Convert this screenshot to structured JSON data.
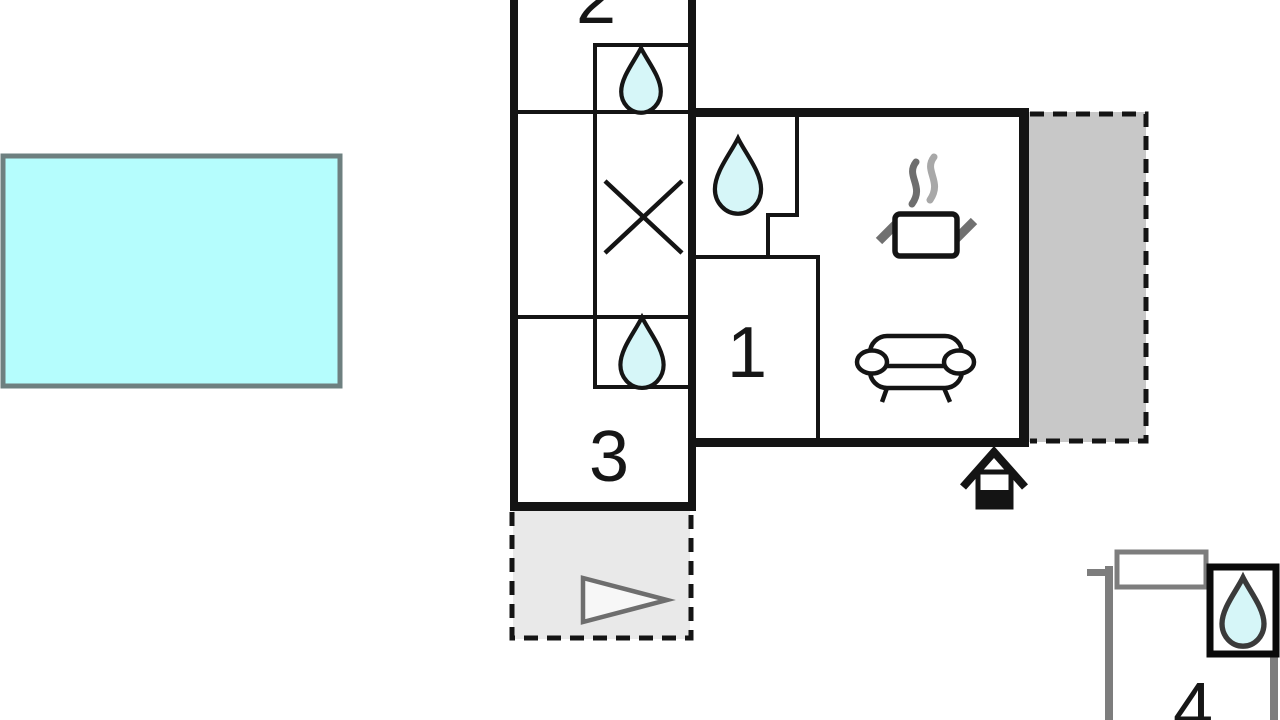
{
  "plan": {
    "type": "apartment-floor-plan",
    "rooms": {
      "room1": {
        "label": "1"
      },
      "room2": {
        "label": "2"
      },
      "room3": {
        "label": "3"
      },
      "room4": {
        "label": "4"
      }
    },
    "icons": [
      "water-drop-icon",
      "water-drop-icon",
      "water-drop-icon",
      "water-drop-icon",
      "x-cross-icon",
      "cooking-pot-steam-icon",
      "sofa-icon",
      "entrance-house-icon",
      "terrace-triangle-icon"
    ],
    "areas": [
      "pool",
      "terrace-right",
      "terrace-front",
      "room-4-annex"
    ]
  },
  "colors": {
    "pool_fill": "#b5fdfd",
    "pool_border": "#6e8080",
    "drop_fill": "#d6f6f8",
    "drop_outline": "#151515",
    "drop4_outline": "#3a3a3a",
    "terrace_right_fill": "#c8c8c8",
    "terrace_front_fill": "#e9e9e9",
    "triangle_fill": "#f7f7f7",
    "triangle_stroke": "#6e6e6e",
    "gray_wall": "#7d7d7d",
    "wall_black": "#141414",
    "room2_label_color": "#555555",
    "steam_dark": "#6e6e6e",
    "steam_light": "#a8a8a8",
    "handle_gray": "#707070"
  }
}
